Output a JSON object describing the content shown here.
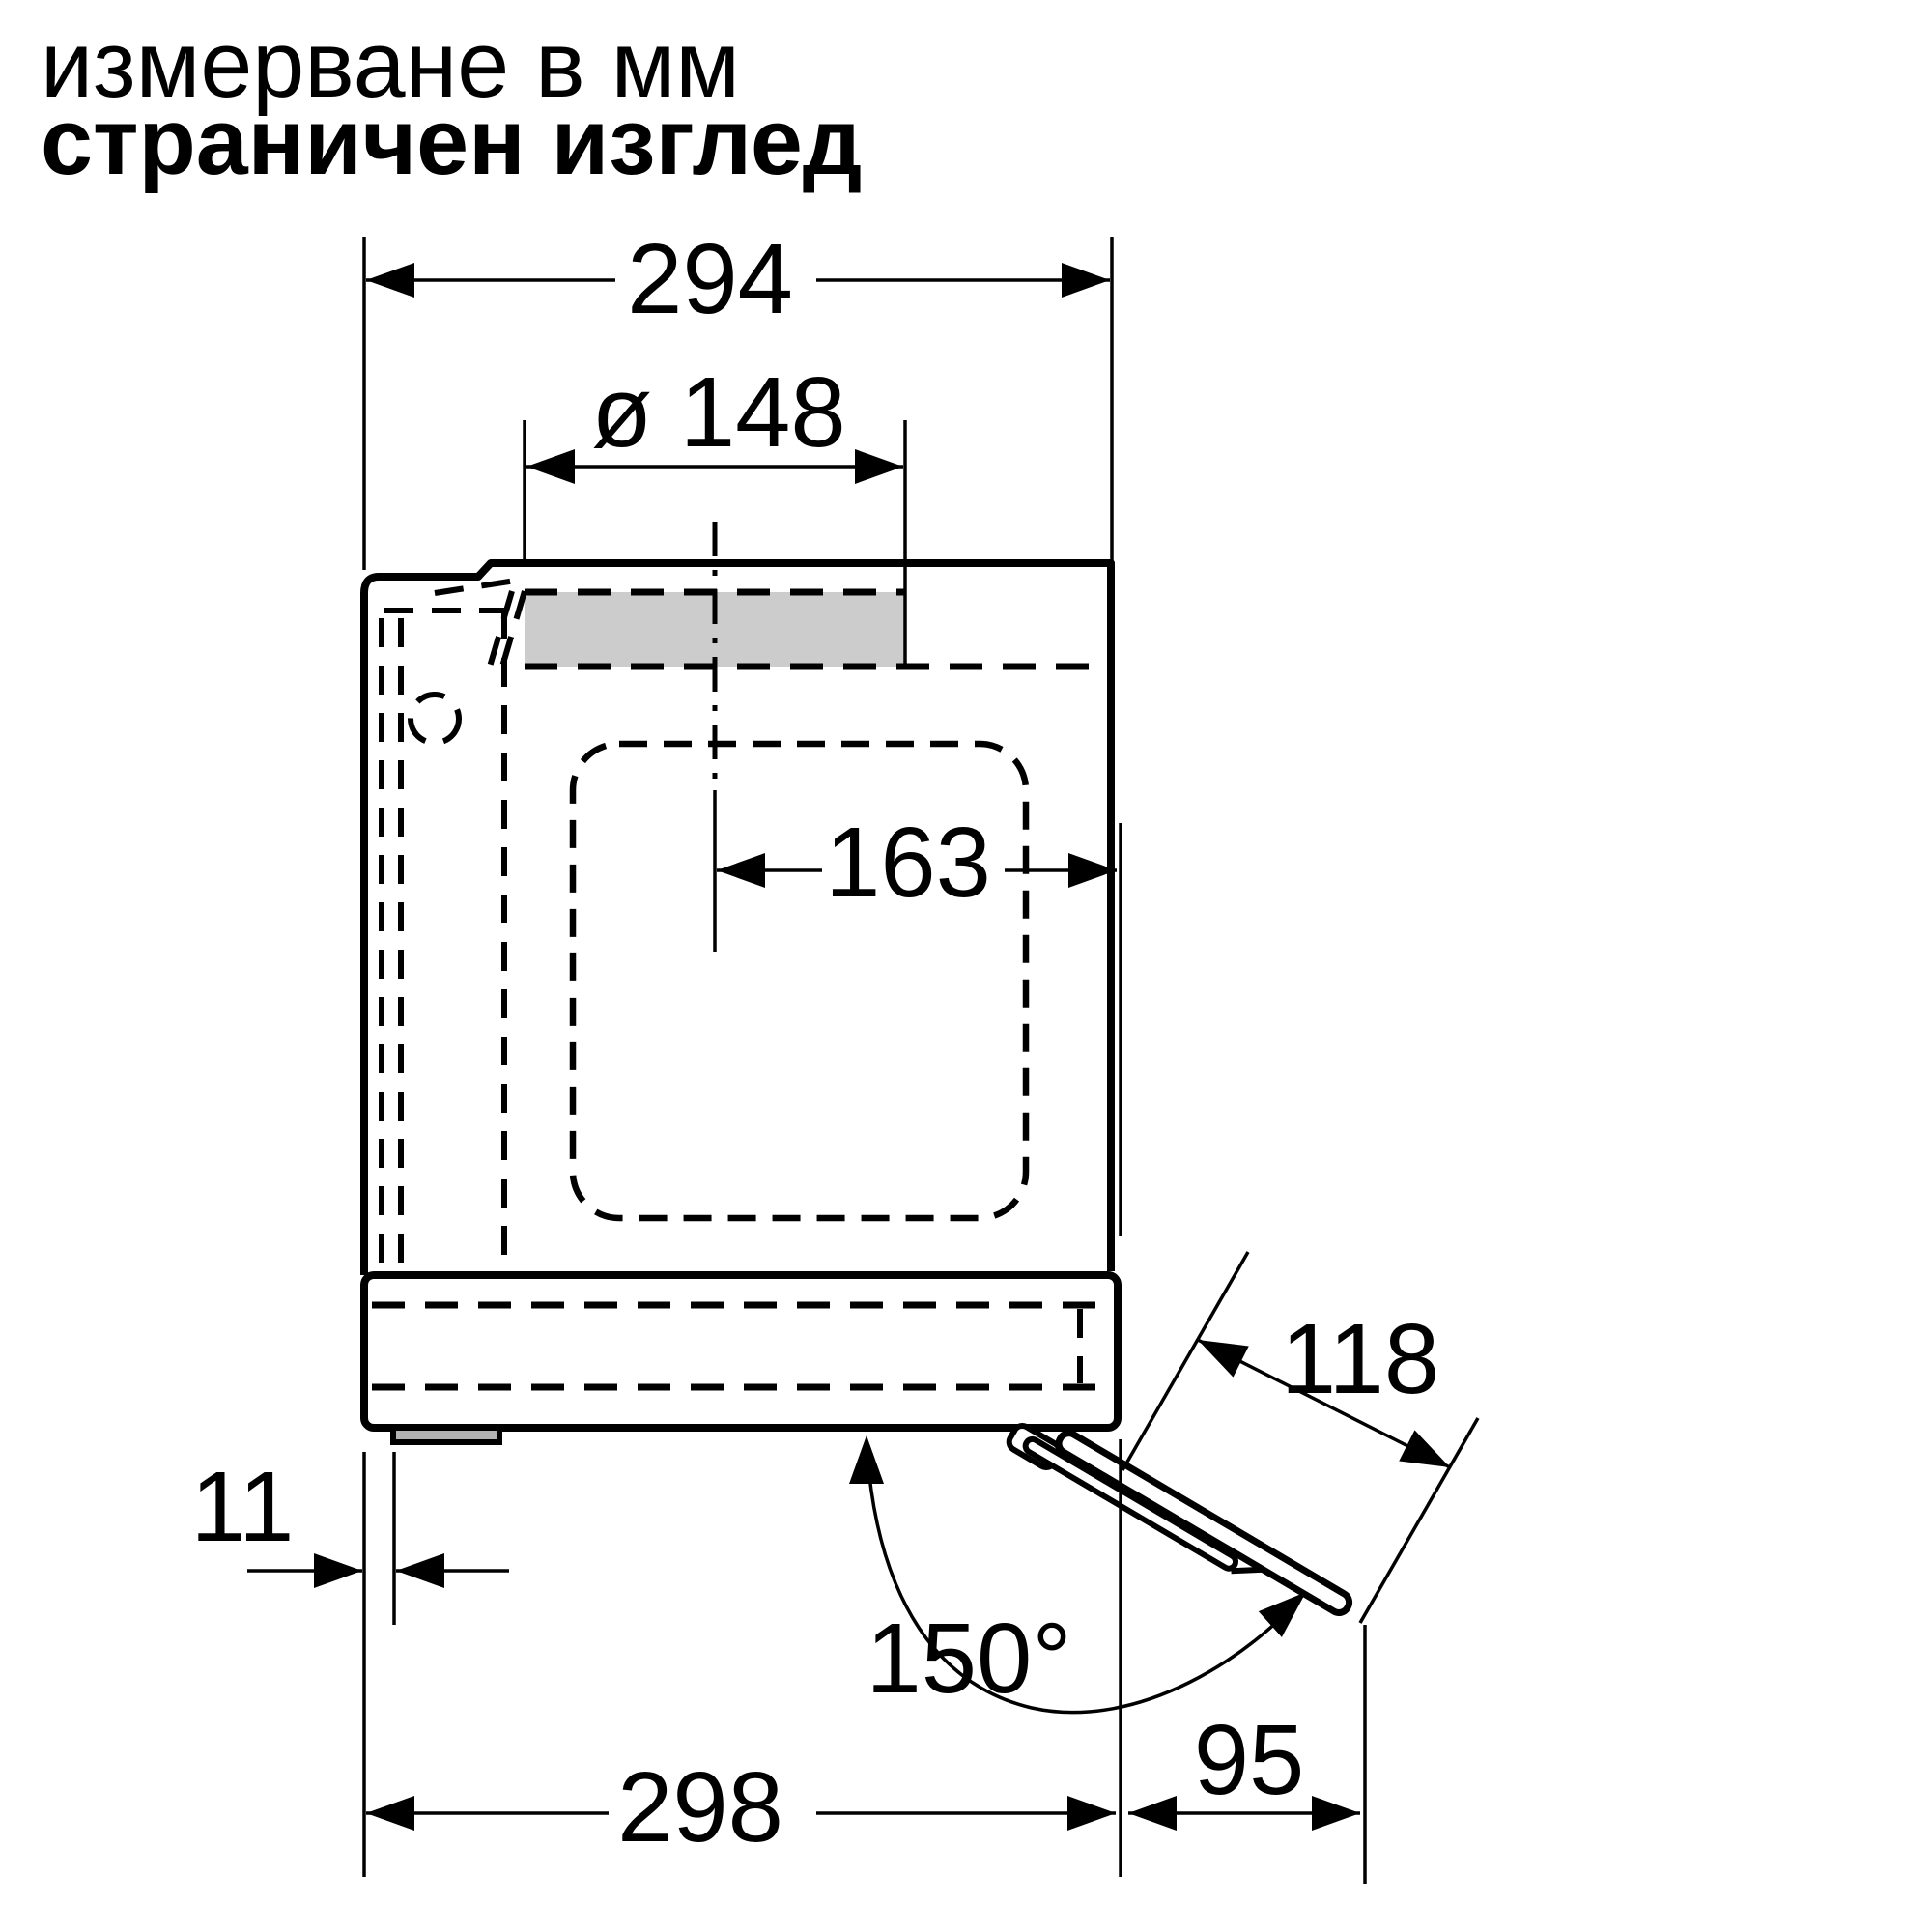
{
  "header": {
    "units_note": "измерване в мм",
    "view_label": "страничен изглед"
  },
  "dimensions": {
    "total_depth_mm": "294",
    "vent_diameter_mm": "ø 148",
    "vent_center_to_front_mm": "163",
    "door_open_length_mm": "118",
    "rear_gap_mm": "11",
    "door_open_angle": "150°",
    "base_depth_mm": "298",
    "door_projection_mm": "95"
  },
  "colors": {
    "ink": "#000000",
    "vent_fill": "#cccccc",
    "foot_fill": "#b3b3b3",
    "background": "#ffffff"
  }
}
